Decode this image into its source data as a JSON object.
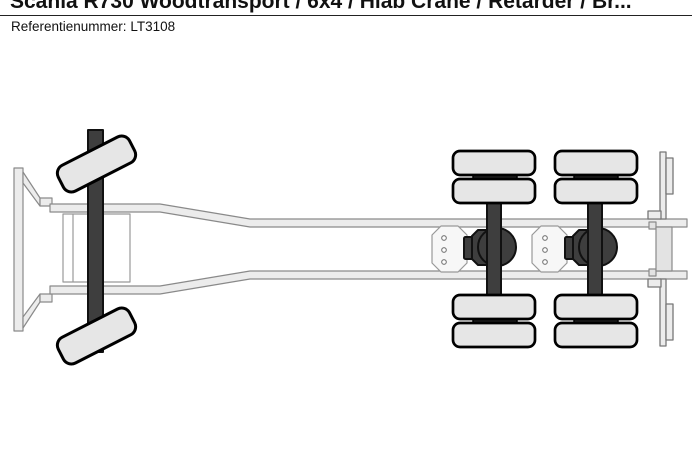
{
  "page": {
    "title": "Scania R730 Woodtransport / 6x4 / Hiab Crane / Retarder / Br...",
    "reference": {
      "label": "Referentienummer:",
      "value": "LT3108"
    }
  },
  "diagram": {
    "name": "truck-chassis-top-view",
    "description": "Top-view technical line drawing of a 6x4 truck chassis with steered front axle and rear tandem axles with dual wheels",
    "components": [
      "front-bumper",
      "chassis-frame-rails",
      "front-inner-frame-box",
      "front-steer-axle",
      "front-wheel-top",
      "front-wheel-bottom",
      "cross-member-plate-1",
      "cross-member-plate-2",
      "rear-axle-1",
      "rear-axle-2",
      "differential-1",
      "differential-2",
      "dual-rear-wheels",
      "rear-cross-member",
      "rear-brackets"
    ],
    "colors": {
      "background": "#ffffff",
      "wheel_fill": "#e6e6e6",
      "frame_fill": "#ececec",
      "frame_outline": "#8a8a8a",
      "axle_dark": "#3e3e3e",
      "outline_black": "#000000"
    }
  }
}
